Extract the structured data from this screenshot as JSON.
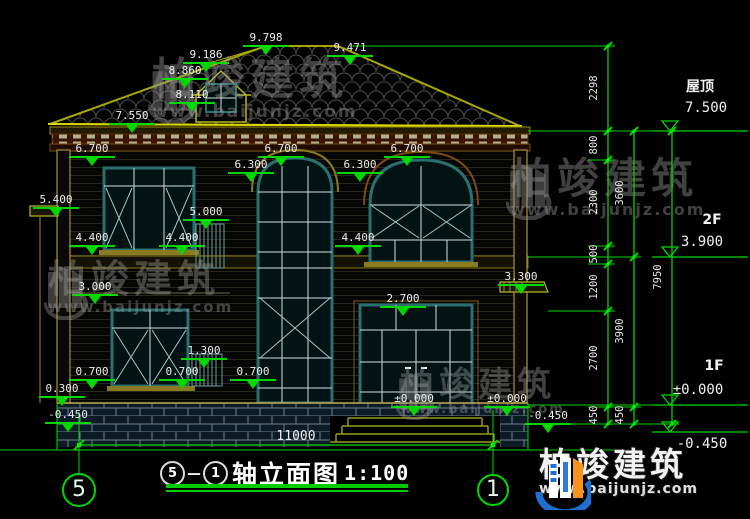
{
  "drawing": {
    "title": "轴立面图",
    "scale": "1:100",
    "axis_left": "5",
    "axis_right": "1",
    "separator": "－",
    "bottom_dimension": "11000"
  },
  "elevation_markers": [
    {
      "t": "9.798",
      "x": 266,
      "y": 46
    },
    {
      "t": "9.471",
      "x": 350,
      "y": 56
    },
    {
      "t": "9.186",
      "x": 206,
      "y": 63
    },
    {
      "t": "8.860",
      "x": 185,
      "y": 79
    },
    {
      "t": "8.110",
      "x": 192,
      "y": 103
    },
    {
      "t": "7.550",
      "x": 132,
      "y": 124
    },
    {
      "t": "6.700",
      "x": 92,
      "y": 157
    },
    {
      "t": "6.700",
      "x": 281,
      "y": 157
    },
    {
      "t": "6.700",
      "x": 407,
      "y": 157
    },
    {
      "t": "6.300",
      "x": 251,
      "y": 173
    },
    {
      "t": "6.300",
      "x": 360,
      "y": 173
    },
    {
      "t": "5.400",
      "x": 56,
      "y": 208
    },
    {
      "t": "5.000",
      "x": 206,
      "y": 220
    },
    {
      "t": "4.400",
      "x": 92,
      "y": 246
    },
    {
      "t": "4.400",
      "x": 182,
      "y": 246
    },
    {
      "t": "4.400",
      "x": 358,
      "y": 246
    },
    {
      "t": "3.300",
      "x": 521,
      "y": 285
    },
    {
      "t": "3.000",
      "x": 95,
      "y": 295
    },
    {
      "t": "2.700",
      "x": 403,
      "y": 307
    },
    {
      "t": "1.300",
      "x": 204,
      "y": 359
    },
    {
      "t": "0.700",
      "x": 92,
      "y": 380
    },
    {
      "t": "0.700",
      "x": 182,
      "y": 380
    },
    {
      "t": "0.700",
      "x": 253,
      "y": 380
    },
    {
      "t": "0.300",
      "x": 62,
      "y": 397
    },
    {
      "t": "-0.450",
      "x": 68,
      "y": 423
    },
    {
      "t": "±0.000",
      "x": 414,
      "y": 407
    },
    {
      "t": "±0.000",
      "x": 507,
      "y": 407
    },
    {
      "t": "-0.450",
      "x": 548,
      "y": 424
    }
  ],
  "right_chain": {
    "col1": [
      "2298",
      "800",
      "2300",
      "500",
      "1200",
      "2700",
      "450"
    ],
    "col2": [
      "3600",
      "3900",
      "450"
    ],
    "col3": [
      "7950"
    ]
  },
  "right_levels": [
    {
      "name": "屋顶",
      "value": "7.500"
    },
    {
      "name": "2F",
      "value": "3.900"
    },
    {
      "name": "1F",
      "value": "±0.000"
    },
    {
      "name": "",
      "value": "-0.450"
    }
  ],
  "watermark": {
    "brand": "柏竣建筑",
    "url": "www.baijunjz.com"
  },
  "logo": {
    "brand": "柏竣建筑",
    "url": "www.baijunjz.com"
  },
  "colors": {
    "dim_green": "#00d800",
    "cad_olive": "#a8923a",
    "roof_edge": "#b8b820",
    "window_teal": "#2a7070",
    "brand_blue": "#1d6fd0",
    "brand_orange": "#f7941d"
  }
}
